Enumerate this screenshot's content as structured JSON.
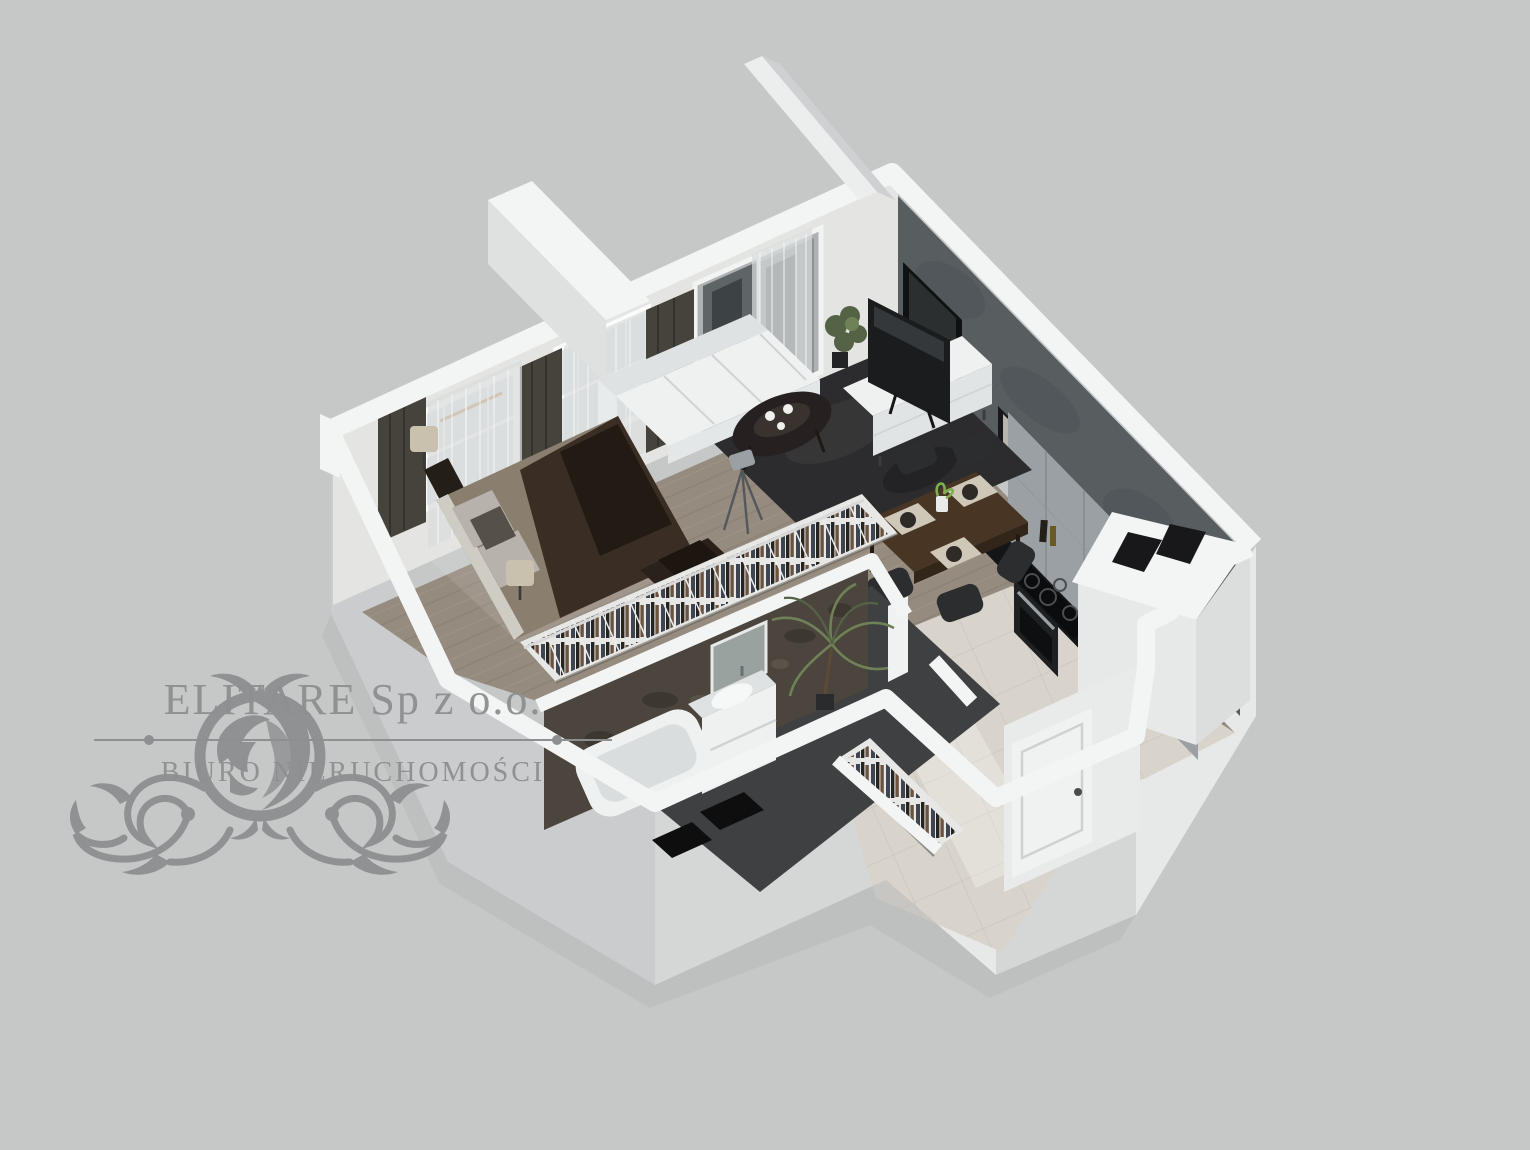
{
  "watermark": {
    "company": "ELITARE Sp z o.o.",
    "tagline": "BIURO NIERUCHOMOŚCI",
    "icon": "lion-crest-ornament"
  },
  "colors": {
    "bg": "#c6c7c7",
    "wallTop": "#f3f4f4",
    "wallFaceLight": "#e7e8e8",
    "wallFaceMid": "#d5d6d6",
    "wallFaceDark": "#cbcccd",
    "wallInner": "#e4e4e2",
    "glass": "#dfe3e4",
    "curtainDark": "#46433d",
    "sheer": "#dadddd",
    "accentWall": "#585d60",
    "stoneWall": "#4c453d",
    "woodFloor": "#968b7f",
    "tileFloor": "#d8d4cc",
    "bathFloor": "#3f4042",
    "rug": "#2c2c2e",
    "whiteFurniture": "#eff1f1",
    "darkFurniture": "#2f3032",
    "duvet": "#3a2e24",
    "duvetDark": "#221b14",
    "pillow": "#b7b3ac",
    "lampShade": "#c9c0ad",
    "tableWood": "#483524",
    "chair": "#2b2d2f",
    "cabinet": "#9aa0a4",
    "counter": "#141517",
    "plantGreen": "#546246",
    "plantLight": "#6f8257",
    "door": "#f0f1f1",
    "watermark": "#8e8f90"
  },
  "scene": {
    "type": "isometric-3d-floor-plan",
    "areas": [
      "bedroom-living-area",
      "kitchen",
      "dining-area",
      "bathroom",
      "entry-hall",
      "balcony-wall"
    ],
    "furniture": [
      "double-bed",
      "bedside-lamps",
      "wardrobe-rail",
      "sofa",
      "coffee-table",
      "tripod-floor-lamp",
      "tv-sideboard",
      "wall-tv",
      "wall-art",
      "area-rug",
      "dining-table",
      "dining-chairs",
      "kitchen-cabinets",
      "cooktop",
      "oven",
      "ventilation-shaft",
      "bathtub",
      "vanity-sink",
      "bathroom-mirror",
      "bath-mats",
      "entry-wardrobe",
      "front-door",
      "potted-plants"
    ]
  }
}
